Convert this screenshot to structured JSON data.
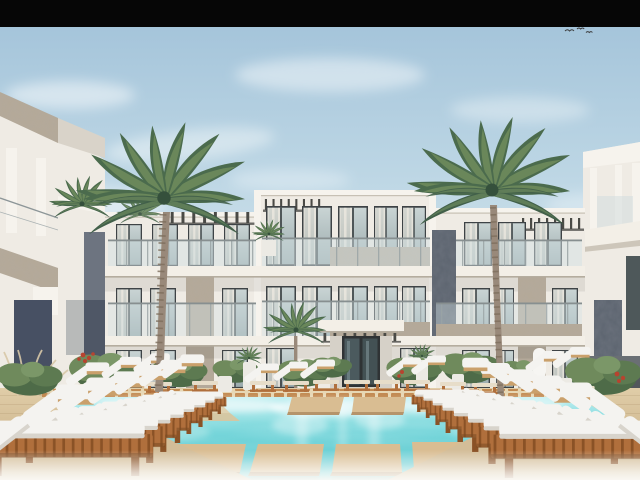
{
  "scene": {
    "type": "architectural-exterior-render",
    "description": "Daylight 3D rendering of a modern white three-story resort apartment building with glass balcony railings, stone accent panels and pergolas; two tall palm trees in front; landscaped poolside shrubs and planters; rows of wooden sun loungers with white cushions on sandy decks; turquoise swimming pool with wooden stepping platforms; flanking buildings at left and right edges; black letterbox bar across the top.",
    "time_of_day": "day",
    "letterbox_top_height_px": 27,
    "flying_birds_count": 3,
    "elements": [
      "letterbox-top",
      "sky",
      "clouds",
      "flying-birds",
      "left-building",
      "main-building",
      "right-building",
      "left-palm-tree",
      "right-palm-tree",
      "small-palm-trees",
      "poolside-plants",
      "planters",
      "poolside-furniture",
      "pool-deck",
      "pool",
      "pool-steps",
      "wooden-platforms",
      "sun-loungers-left",
      "sun-loungers-right",
      "bottom-haze"
    ]
  },
  "palette": {
    "black_bar": "#060606",
    "sky_top": "#a4c4da",
    "sky_low": "#e7f0f3",
    "cloud": "#f6fafb",
    "wall_white": "#efebe4",
    "wall_bright": "#f6f3ed",
    "wall_shadow": "#d9d3c9",
    "slab": "#f3efe7",
    "slab_shadow": "#b5ad9f",
    "glass_dark": "#3e4346",
    "curtain": "#e9e3d8",
    "stone_base": "#b4a998",
    "slate_base": "#5b636e",
    "navy_panel": "#475063",
    "gray_bay": "#6d7480",
    "gray_bay_dark": "#4f5766",
    "palm_green": "#4b6b4d",
    "palm_green_light": "#74905f",
    "palm_green_dark": "#35503c",
    "trunk": "#99897a",
    "trunk_dark": "#7d6e5d",
    "deck": "#d3bd98",
    "deck_dark": "#c1a77e",
    "wood_plank": "#d9bd92",
    "plank_shadow": "#b5946b",
    "cope_block": "#c28a52",
    "cope_bg": "#e7d7b4",
    "lounger_wood": "#b06f3c",
    "lounger_wood_dark": "#8a5226",
    "cushion": "#f4f3f0",
    "cushion_shadow": "#d8d4cc",
    "pool_light": "#bfeef0",
    "pool_deep": "#5ac9cf",
    "shrub": "#4e6b48",
    "shrub_light": "#6f8a5c",
    "flower_red": "#b8432f",
    "pot_white": "#eceae4",
    "pampas": "#d8c8a8",
    "bird": "#3a3a3a"
  }
}
